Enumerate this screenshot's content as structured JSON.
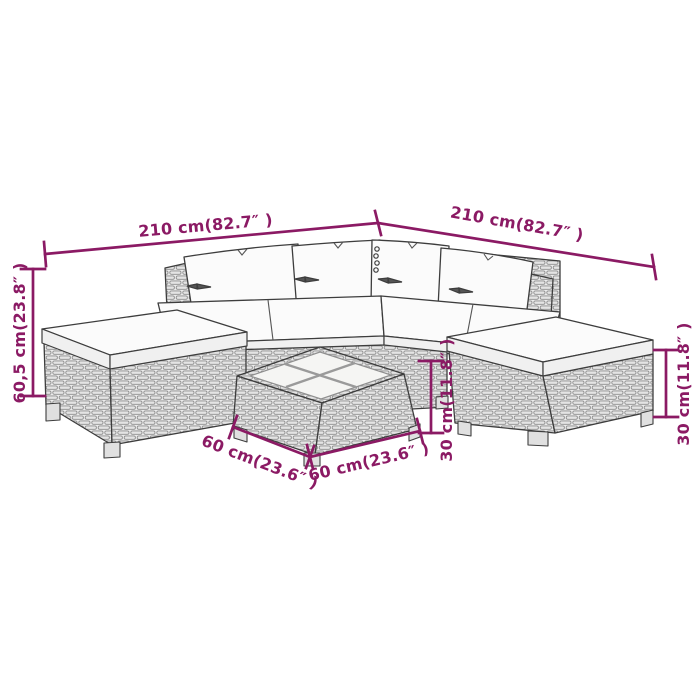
{
  "diagram": {
    "type": "product-dimension-diagram",
    "subject": "poly rattan garden lounge set",
    "pieces": [
      "corner sofa left section",
      "corner sofa right section",
      "left ottoman",
      "right ottoman",
      "coffee table with glass top panels",
      "back pillows x4",
      "seat cushions"
    ]
  },
  "colors": {
    "dimension_annotation": "#8B1A64",
    "line_art_outline": "#3d3d3d",
    "rattan_fill": "#ececec",
    "rattan_weave_stroke": "#8d8d8d",
    "cushion_fill": "#fbfbfb",
    "background": "#ffffff"
  },
  "dimensions": {
    "left_width": {
      "label": "210 cm(82.7″ )",
      "cm": 210,
      "inches": 82.7
    },
    "right_width": {
      "label": "210 cm(82.7″ )",
      "cm": 210,
      "inches": 82.7
    },
    "overall_height": {
      "label": "60,5 cm(23.8″ )",
      "cm": 60.5,
      "inches": 23.8
    },
    "table_height": {
      "label": "30 cm(11.8″ )",
      "cm": 30,
      "inches": 11.8
    },
    "ottoman_height": {
      "label": "30 cm(11.8″ )",
      "cm": 30,
      "inches": 11.8
    },
    "table_depth": {
      "label": "60 cm(23.6″ )",
      "cm": 60,
      "inches": 23.6
    },
    "table_width": {
      "label": "60 cm(23.6″ )",
      "cm": 60,
      "inches": 23.6
    }
  }
}
